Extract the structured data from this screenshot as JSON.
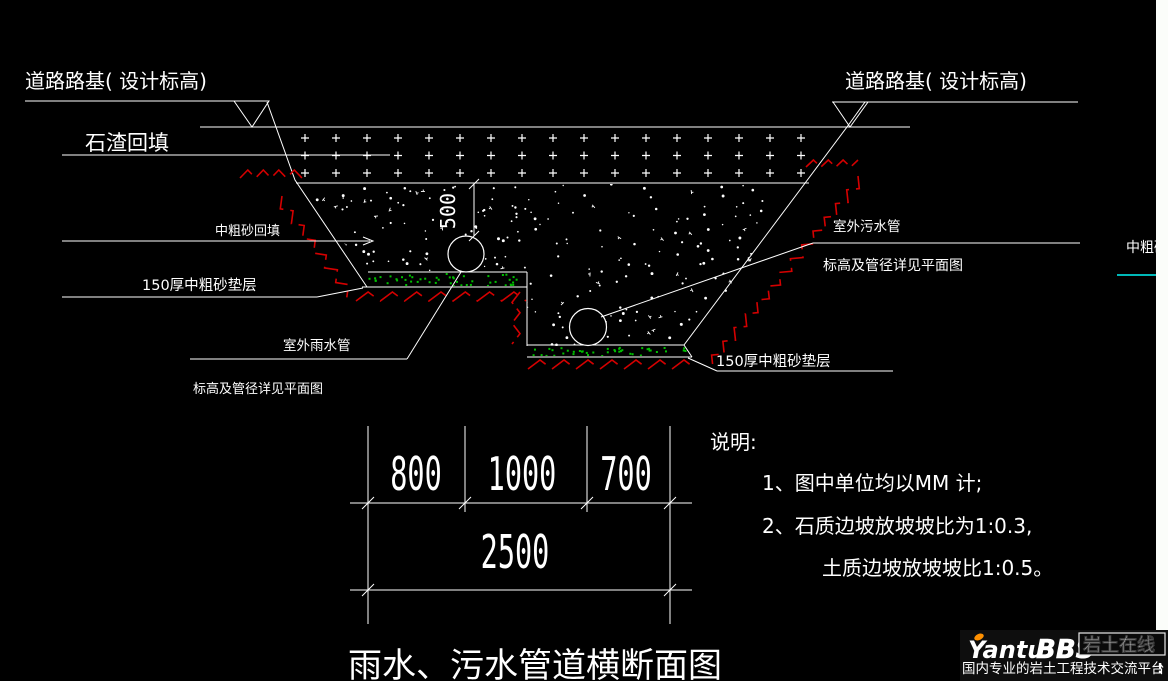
{
  "drawing": {
    "labels": {
      "road_left": "道路路基( 设计标高)",
      "road_right": "道路路基( 设计标高)",
      "stone_fill": "石渣回填",
      "sand_fill": "中粗砂回填",
      "bedding_left": "150厚中粗砂垫层",
      "bedding_right": "150厚中粗砂垫层",
      "rain_pipe": "室外雨水管",
      "rain_pipe_note": "标高及管径详见平面图",
      "sewage_pipe": "室外污水管",
      "sewage_pipe_note": "标高及管径详见平面图",
      "edge_fragment": "中粗砂"
    },
    "dimensions": {
      "d800": "800",
      "d1000": "1000",
      "d700": "700",
      "d2500": "2500",
      "d500": "500"
    },
    "notes": {
      "heading": "说明:",
      "line1": "1、图中单位均以MM 计;",
      "line2": "2、石质边坡放坡坡比为1:0.3,",
      "line3": "土质边坡放坡坡比1:0.5。"
    },
    "title": "雨水、污水管道横断面图",
    "colors": {
      "line": "#ffffff",
      "hatch_red": "#d40000",
      "title_red": "#e60000",
      "bedding_green": "#00c000",
      "cyan_line": "#00b8b8",
      "strip_white": "#fbfdfa"
    }
  },
  "logo": {
    "brand_yantu": "Yantu",
    "brand_bbs": "BBS",
    "brand_cn": "岩土在线",
    "tagline": "国内专业的岩土工程技术交流平台",
    "tagline_mark": "!",
    "accent": "#ff9000"
  }
}
